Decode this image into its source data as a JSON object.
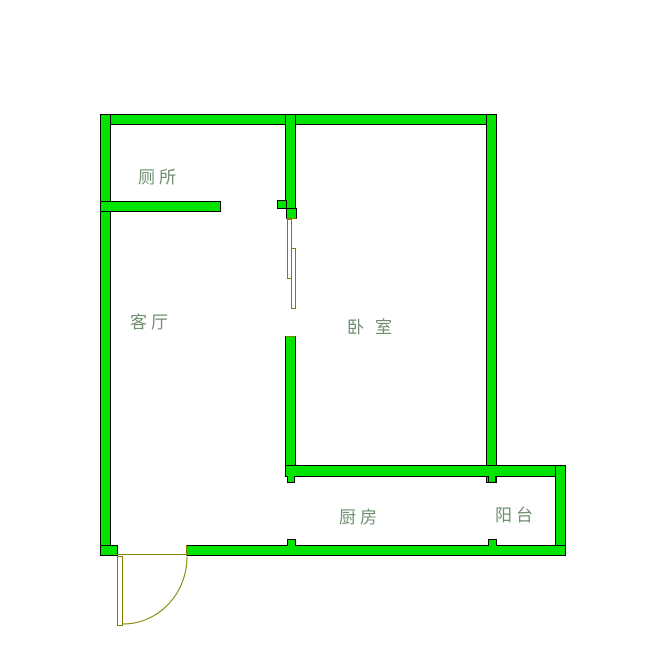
{
  "colors": {
    "wall_fill": "#00E400",
    "wall_outline": "#000000",
    "door": "#808000",
    "label": "#6F8F6F",
    "background": "#FFFFFF"
  },
  "rooms": {
    "toilet": {
      "label": "厕所"
    },
    "living_room": {
      "label": "客厅"
    },
    "bedroom": {
      "label": "卧室"
    },
    "kitchen": {
      "label": "厨房"
    },
    "balcony": {
      "label": "阳台"
    }
  }
}
